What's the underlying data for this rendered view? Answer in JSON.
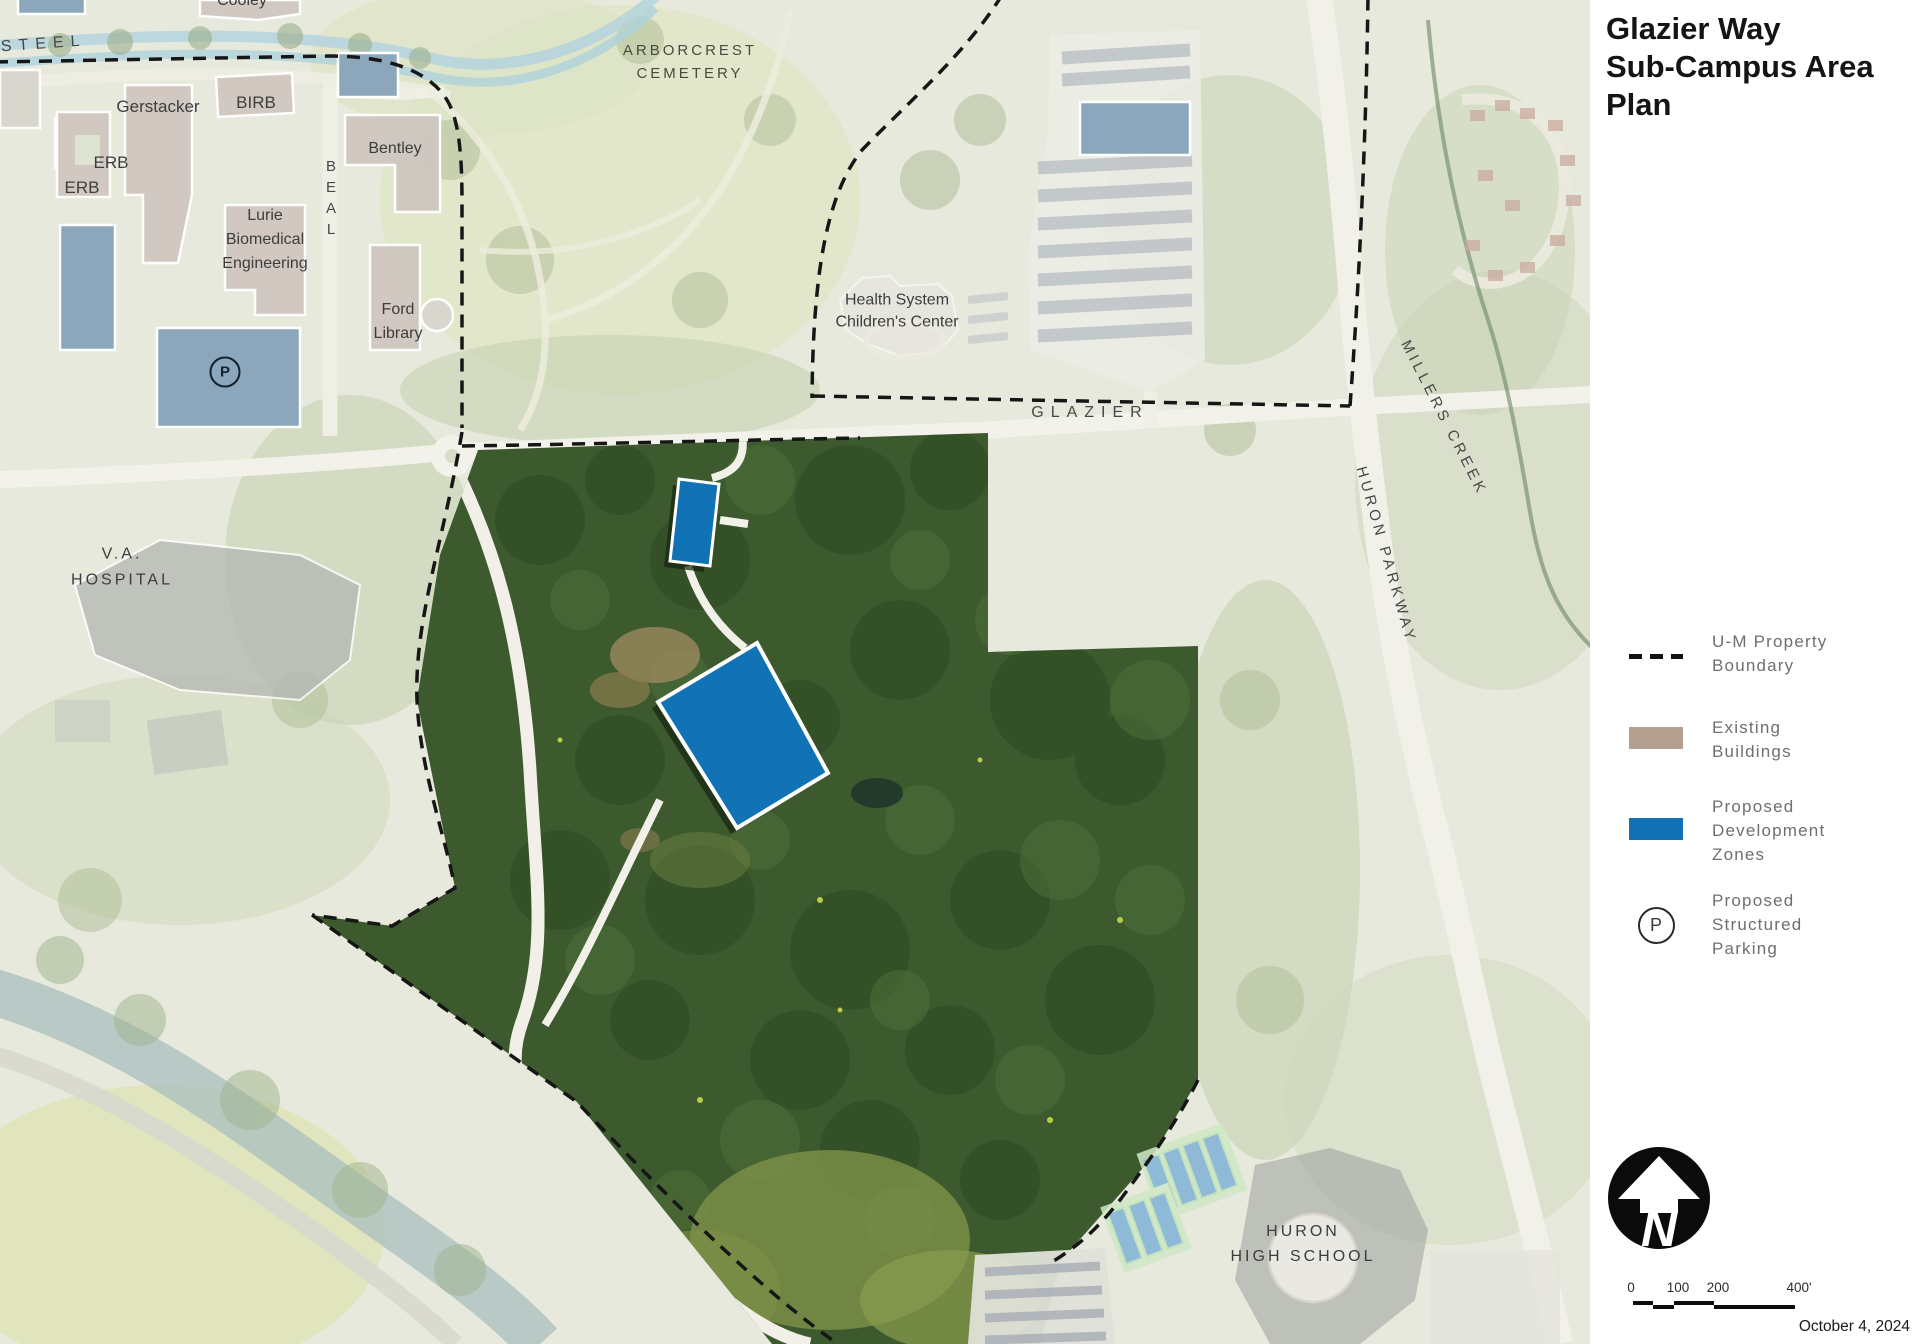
{
  "panel": {
    "title": "Glazier Way\nSub-Campus Area\nPlan",
    "legend": {
      "items": [
        {
          "id": "um-property-boundary",
          "label": "U-M Property\nBoundary",
          "swatch": "dashed-line"
        },
        {
          "id": "existing-buildings",
          "label": "Existing\nBuildings",
          "swatch": "tan-rect"
        },
        {
          "id": "proposed-development-zones",
          "label": "Proposed\nDevelopment\nZones",
          "swatch": "blue-rect"
        },
        {
          "id": "proposed-structured-parking",
          "label": "Proposed\nStructured\nParking",
          "swatch": "p-circle"
        }
      ],
      "parking_letter": "P"
    },
    "north_letter": "N",
    "scale": {
      "ticks": [
        "0",
        "100",
        "200",
        "400'"
      ]
    },
    "date": "October 4, 2024"
  },
  "map": {
    "labels": {
      "cooley": "Cooley",
      "isteel": "ISTEEL",
      "gerstacker": "Gerstacker",
      "birb": "BIRB",
      "erb_upper": "ERB",
      "erb_lower": "ERB",
      "bentley": "Bentley",
      "lurie": "Lurie\nBiomedical\nEngineering",
      "ford_library": "Ford\nLibrary",
      "beal": "BEAL",
      "arborcrest": "ARBORCREST\nCEMETERY",
      "health_system": "Health System\nChildren's Center",
      "glazier": "GLAZIER",
      "millers_creek": "MILLERS CREEK",
      "huron_parkway": "HURON PARKWAY",
      "va_hospital": "V.A.\nHOSPITAL",
      "huron_high_school": "HURON\nHIGH SCHOOL",
      "parking_badge": "P"
    }
  },
  "colors": {
    "proposed_dev_blue": "#1173b6",
    "existing_buildings_tan": "#b3a091",
    "parking_structure_blue": "#8ca7bc",
    "site_forest_green": "#3c5a2e",
    "boundary_black": "#161616"
  }
}
